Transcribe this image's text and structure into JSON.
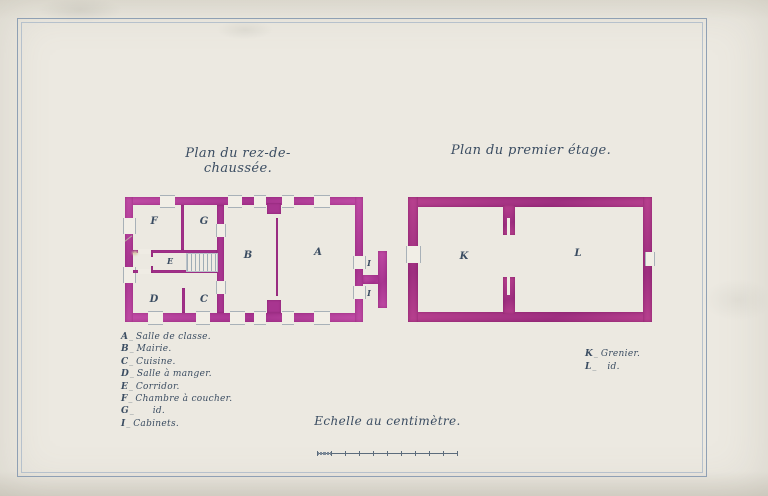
{
  "colors": {
    "paper": "#ece9e1",
    "ink": "#3a4c61",
    "frame": "#8fa0b4",
    "wall": "#c14da6",
    "wall_dark": "#a83590",
    "wall_light": "#cf6fb8",
    "stair": "#9fadb6"
  },
  "titles": {
    "left": "Plan du rez-de-chaussée.",
    "right": "Plan du premier étage."
  },
  "ground_floor": {
    "rooms": {
      "A": "A",
      "B": "B",
      "C": "C",
      "D": "D",
      "E": "E",
      "F": "F",
      "G": "G",
      "I_top": "I",
      "I_bottom": "I"
    }
  },
  "first_floor": {
    "rooms": {
      "K": "K",
      "L": "L"
    }
  },
  "legend_left": {
    "items": [
      {
        "letter": "A",
        "label": "Salle de classe."
      },
      {
        "letter": "B",
        "label": "Mairie."
      },
      {
        "letter": "C",
        "label": "Cuisine."
      },
      {
        "letter": "D",
        "label": "Salle à manger."
      },
      {
        "letter": "E",
        "label": "Corridor."
      },
      {
        "letter": "F",
        "label": "Chambre à coucher."
      },
      {
        "letter": "G",
        "label": "id."
      },
      {
        "letter": "I",
        "label": "Cabinets."
      }
    ]
  },
  "legend_right": {
    "items": [
      {
        "letter": "K",
        "label": "Grenier."
      },
      {
        "letter": "L",
        "label": "id."
      }
    ]
  },
  "scale": {
    "label": "Echelle au centimètre.",
    "divisions": 10,
    "subdivisions": 10
  }
}
